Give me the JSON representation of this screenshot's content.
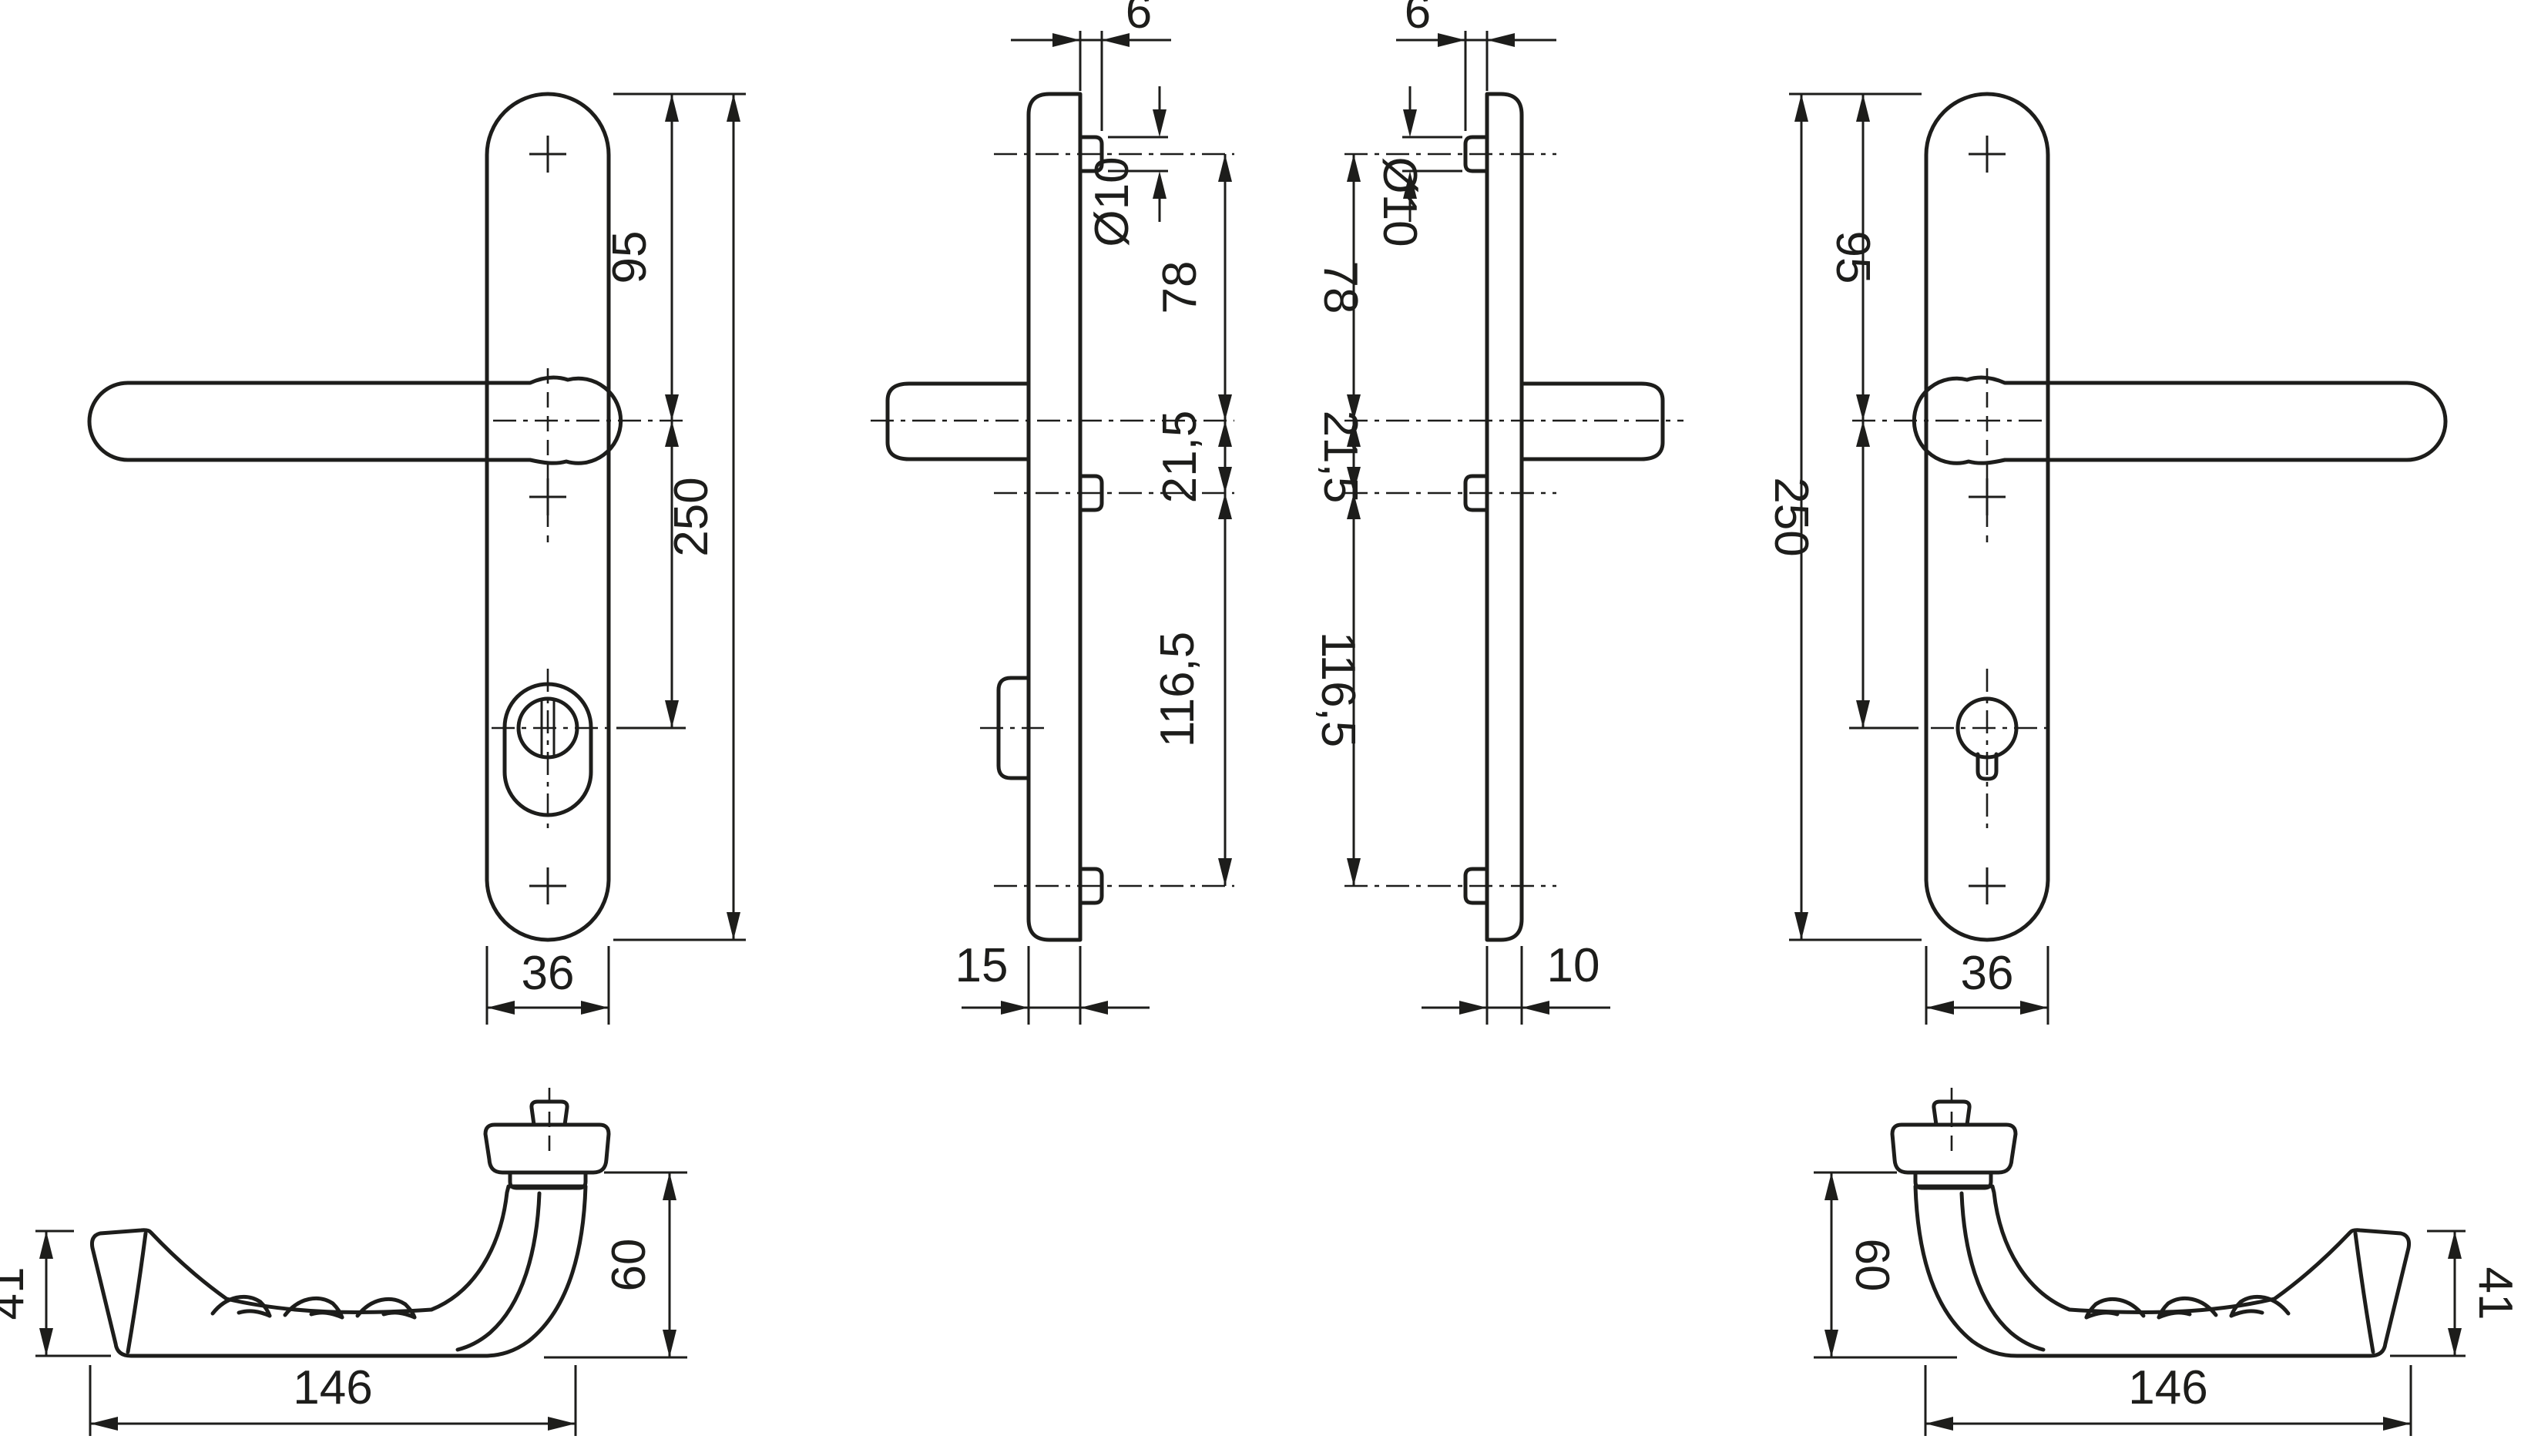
{
  "drawing": {
    "background_color": "#ffffff",
    "line_color": "#1d1d1b",
    "views": {
      "front_left": {
        "title": "front view, lever left, oval cylinder plate",
        "dims": {
          "offset_top": "95",
          "plate_height": "250",
          "plate_width": "36"
        }
      },
      "side_thick": {
        "title": "side profile, 15 mm plate",
        "dims": {
          "lug_projection": "6",
          "lug_diameter": "Ø10",
          "screw_to_handle": "78",
          "handle_to_mid": "21,5",
          "mid_to_screw": "116,5",
          "plate_thickness": "15"
        }
      },
      "side_thin": {
        "title": "side profile, 10 mm plate",
        "dims": {
          "lug_projection": "6",
          "lug_diameter": "Ø10",
          "screw_to_handle": "78",
          "handle_to_mid": "21,5",
          "mid_to_screw": "116,5",
          "plate_thickness": "10"
        }
      },
      "front_right": {
        "title": "front view, lever right, euro profile plate",
        "dims": {
          "offset_top": "95",
          "plate_height": "250",
          "plate_width": "36"
        }
      },
      "handle_left": {
        "title": "handle top view, grip left",
        "dims": {
          "grip_end_height": "41",
          "handle_length": "146",
          "neck_height": "60"
        }
      },
      "handle_right": {
        "title": "handle top view, grip right",
        "dims": {
          "grip_end_height": "41",
          "handle_length": "146",
          "neck_height": "60"
        }
      }
    }
  }
}
